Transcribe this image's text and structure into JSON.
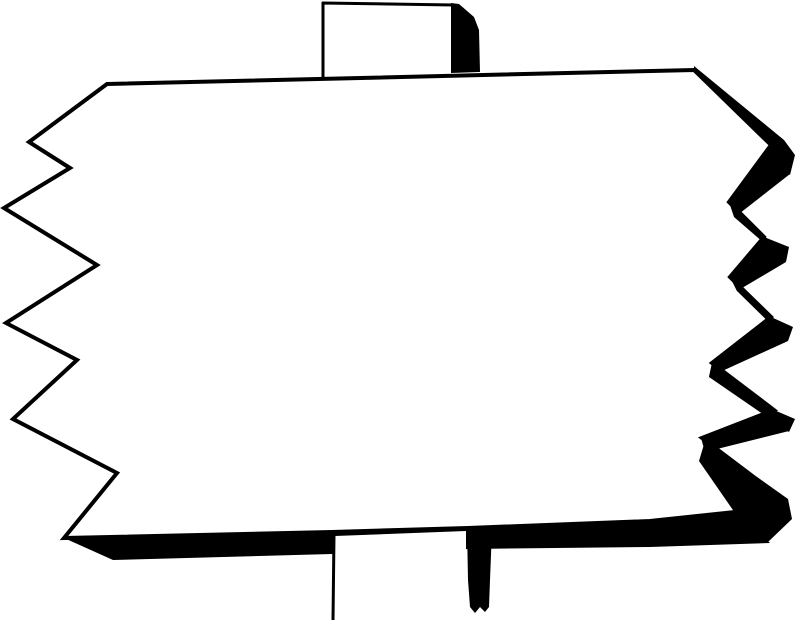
{
  "canvas": {
    "width": 800,
    "height": 621
  },
  "colors": {
    "ink": "#000000",
    "paper": "#ffffff"
  },
  "illustration": {
    "description": "Black-and-white clipart of a blank wooden sign mounted on a post; jagged zigzag side edges, thin outline on top/left, heavy shadow bands on right/bottom",
    "sign_text": ""
  },
  "drawing": {
    "board_face": "107,84 694,70 771,145 729,202 764,237 730,277 771,317 712,363 774,410 702,438 763,484 735,512 650,521 468,528 332,532 64,538 117,473 13,419 77,360 6,323 97,265 4,208 70,168 29,142",
    "bands": [
      "694,66 784,140 795,155 790,175 772,147 694,71",
      "772,146 790,174 735,217 729,201",
      "729,202 764,237 789,247 786,262 734,217",
      "764,238 786,262 737,291 730,277",
      "730,277 771,317 793,327 788,341 737,291",
      "771,318 788,341 709,377 712,363",
      "712,363 774,410 795,419 789,432 709,377",
      "774,410 789,431 705,452 701,438",
      "705,441 764,484 735,513 699,461",
      "757,477 788,499 792,519 768,542 733,513",
      "64,538 332,532 468,528 650,521 735,512 770,543 650,547 468,549 332,554 113,560"
    ],
    "top_post_outline": "M323,2 L323,78 M322,3 L454,5",
    "top_post_shadow": "451,3 459,4 474,17 479,30 480,72 451,73",
    "bottom_post_face": "335,536 466,531 466,561 335,566",
    "bottom_post_edge": "M334,534 L333,620",
    "bottom_post_shadow": "467,529 492,530 490,580 489,607 485,612 480,607 475,613 470,607 468,580"
  }
}
